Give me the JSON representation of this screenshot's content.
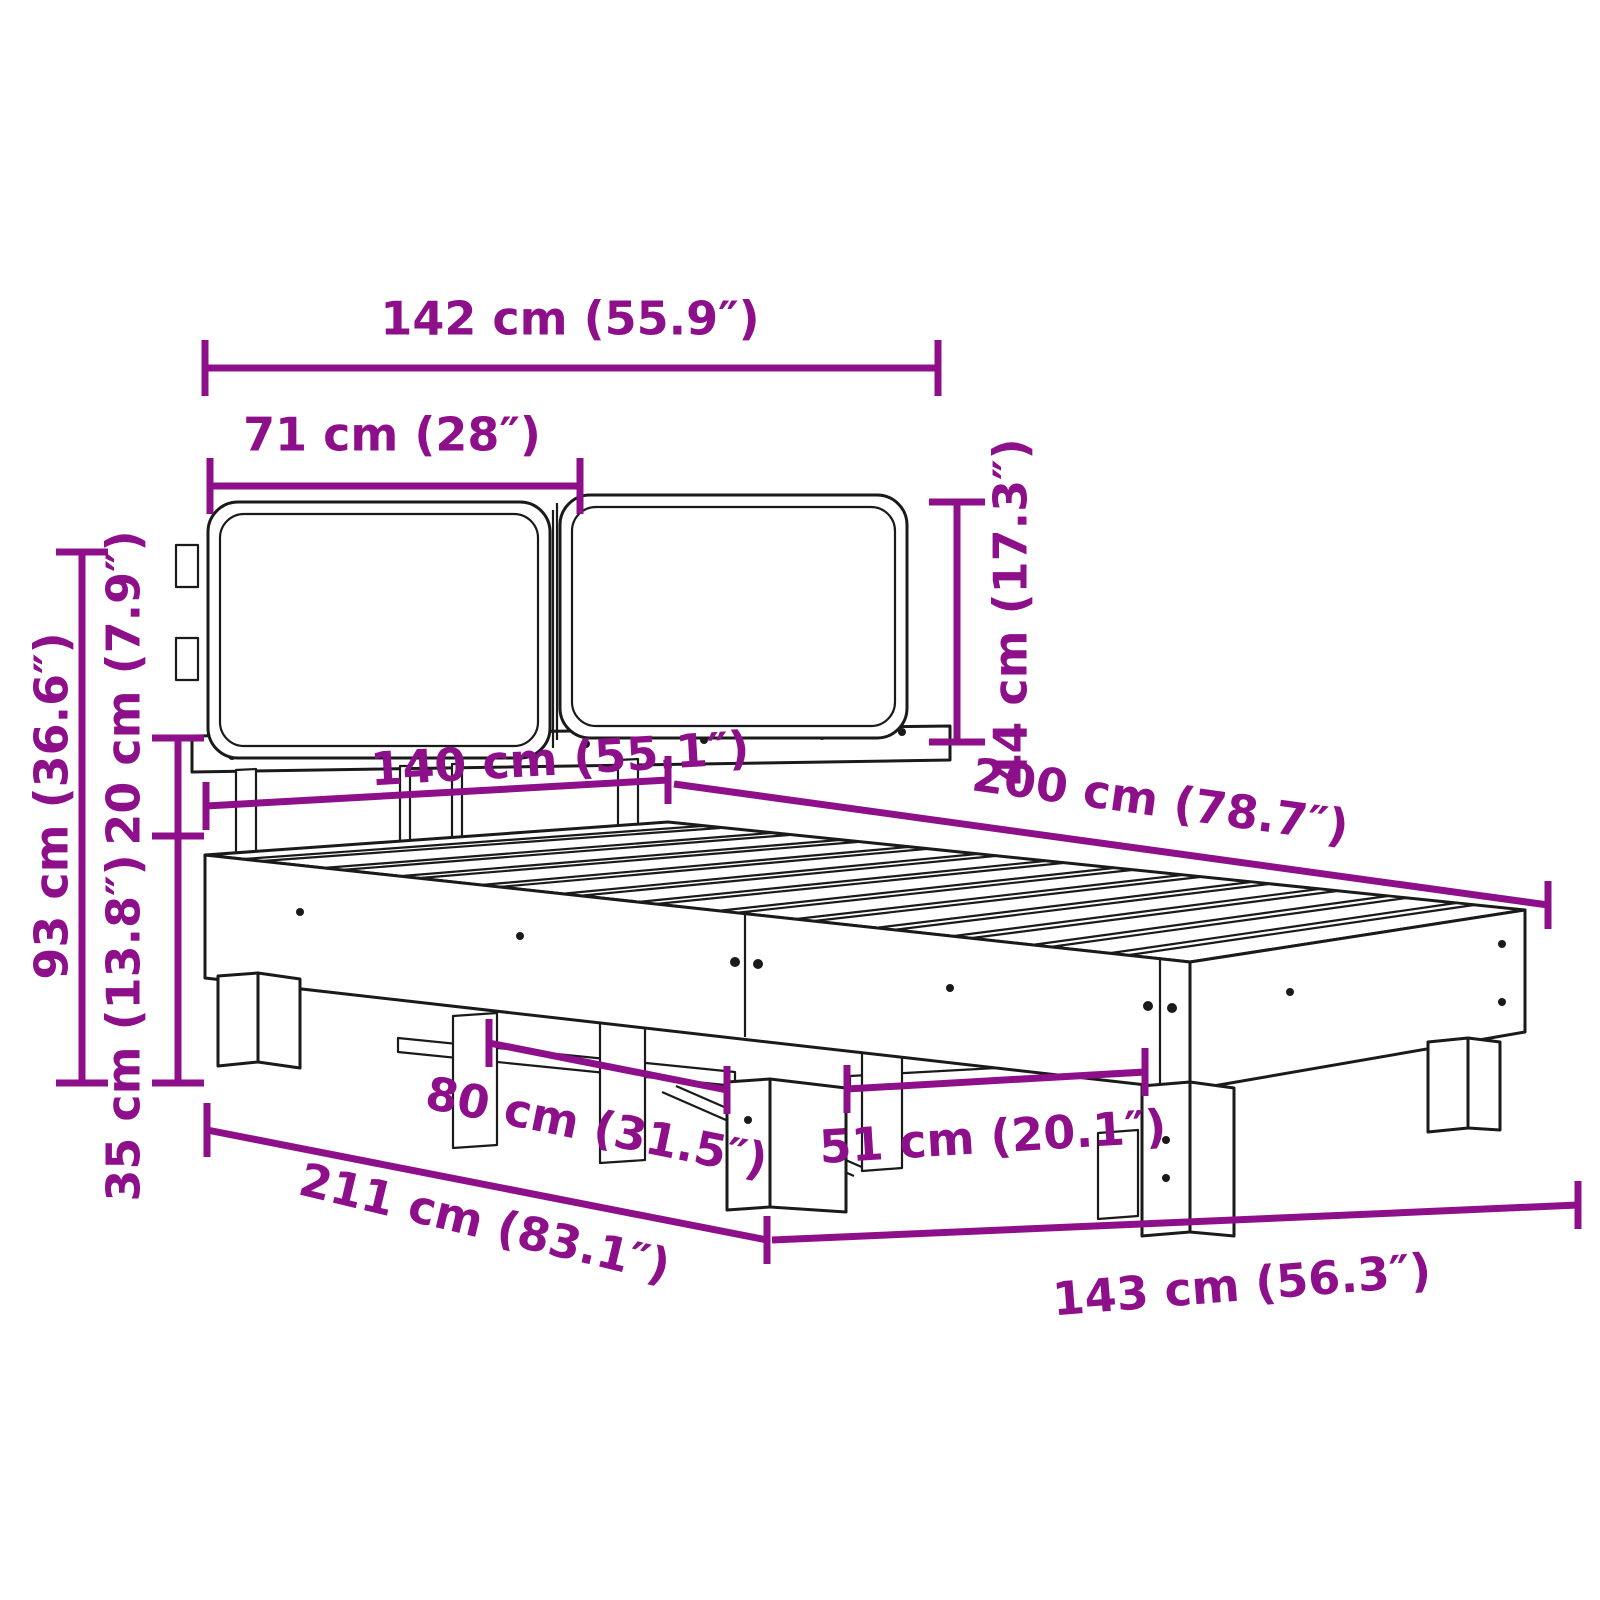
{
  "diagram": {
    "type": "furniture-dimension-drawing",
    "subject": "bed frame with two headboard cushions",
    "colors": {
      "dimension_accent": "#8e0f8a",
      "line_art": "#1a1a1a",
      "background": "#ffffff"
    },
    "dimensions": {
      "headboard_width": {
        "label": "142 cm (55.9″)",
        "cm": 142,
        "inches": 55.9
      },
      "cushion_width": {
        "label": "71 cm (28″)",
        "cm": 71,
        "inches": 28
      },
      "cushion_height": {
        "label": "44 cm (17.3″)",
        "cm": 44,
        "inches": 17.3
      },
      "bed_width": {
        "label": "140 cm (55.1″)",
        "cm": 140,
        "inches": 55.1
      },
      "bed_length": {
        "label": "200 cm (78.7″)",
        "cm": 200,
        "inches": 78.7
      },
      "total_height": {
        "label": "93 cm (36.6″)",
        "cm": 93,
        "inches": 36.6
      },
      "frame_height": {
        "label": "20 cm (7.9″)",
        "cm": 20,
        "inches": 7.9
      },
      "leg_height": {
        "label": "35 cm (13.8″)",
        "cm": 35,
        "inches": 13.8
      },
      "support_spacing_front": {
        "label": "80 cm (31.5″)",
        "cm": 80,
        "inches": 31.5
      },
      "support_spacing_foot": {
        "label": "51 cm (20.1″)",
        "cm": 51,
        "inches": 20.1
      },
      "total_length": {
        "label": "211 cm (83.1″)",
        "cm": 211,
        "inches": 83.1
      },
      "base_width": {
        "label": "143 cm (56.3″)",
        "cm": 143,
        "inches": 56.3
      }
    }
  }
}
